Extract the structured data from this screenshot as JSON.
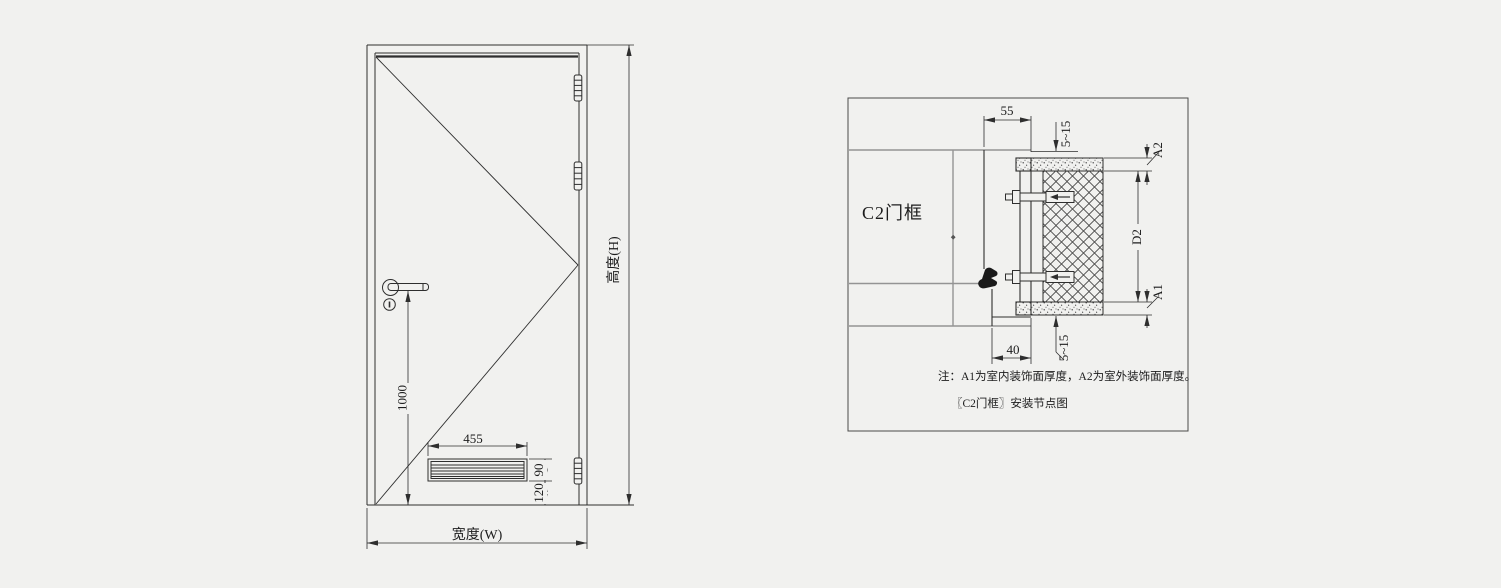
{
  "colors": {
    "background": "#f1f1ef",
    "line": "#2e2e2e",
    "light_line": "#949494",
    "text": "#1c1c1c"
  },
  "door_elevation": {
    "width_label": "宽度(W)",
    "height_label": "高度(H)",
    "handle_height": "1000",
    "louver_width": "455",
    "louver_height": "90",
    "louver_bottom_offset": "120"
  },
  "detail": {
    "frame_label": "C2门框",
    "frame_depth": "55",
    "frame_face_width": "40",
    "gap_top": "5~15",
    "gap_bottom": "5~15",
    "outer_finish_label": "A2",
    "wall_thickness_label": "D2",
    "inner_finish_label": "A1",
    "note": "注：A1为室内装饰面厚度，A2为室外装饰面厚度。",
    "title": "〖C2门框〗安装节点图"
  }
}
